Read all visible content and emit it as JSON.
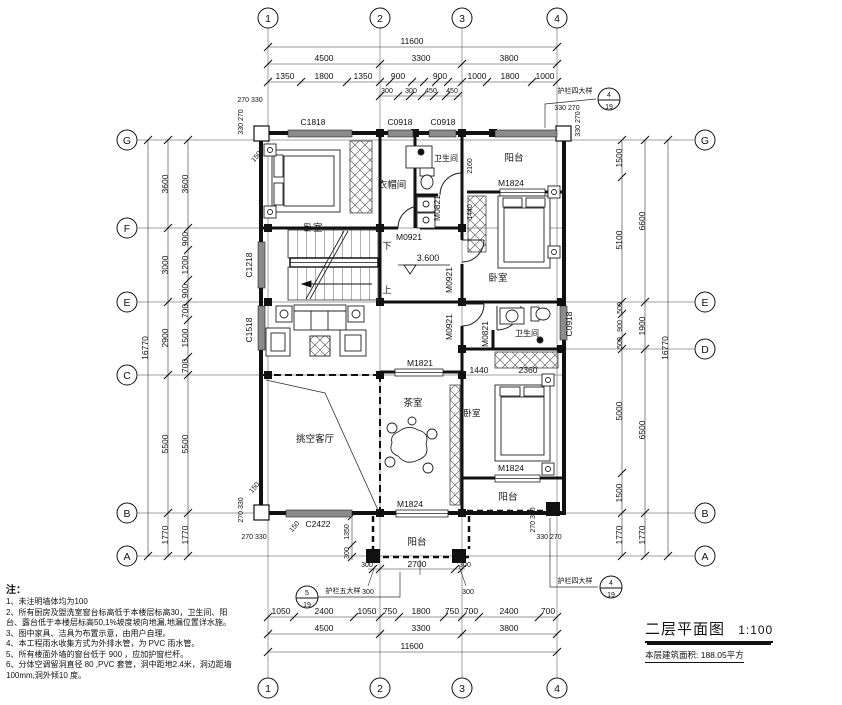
{
  "axes": {
    "top": [
      "1",
      "2",
      "3",
      "4"
    ],
    "bottom": [
      "1",
      "2",
      "3",
      "4"
    ],
    "left": [
      "G",
      "F",
      "E",
      "C",
      "B",
      "A"
    ],
    "right": [
      "G",
      "E",
      "D",
      "B",
      "A"
    ]
  },
  "dims_top": {
    "overall": "11600",
    "row2": [
      "4500",
      "3300",
      "3800"
    ],
    "row3": [
      "1350",
      "1800",
      "1350",
      "900",
      "900",
      "1000",
      "1800",
      "1000"
    ],
    "sub": [
      "300",
      "300",
      "450",
      "450"
    ]
  },
  "dims_bottom": {
    "overall": "11600",
    "row2": [
      "4500",
      "3300",
      "3800"
    ],
    "row3": [
      "1050",
      "2400",
      "1050",
      "750",
      "1800",
      "750",
      "700",
      "2400",
      "700"
    ]
  },
  "dims_left": {
    "overall": "16770",
    "mid": [
      "3600",
      "3000",
      "2900",
      "5500",
      "1770"
    ],
    "fine": [
      "3600",
      "900",
      "1200",
      "900",
      "700",
      "1500",
      "700",
      "5500",
      "1770"
    ]
  },
  "dims_right": {
    "overall": "16770",
    "mid": [
      "6600",
      "1900",
      "6500",
      "1770"
    ],
    "fine": [
      "1500",
      "5100",
      "500",
      "900",
      "500",
      "5000",
      "1500",
      "1770"
    ]
  },
  "corner_dims": {
    "tl_h": "270 330",
    "tl_v": "330 270",
    "tr_h": "330 270",
    "tr_v": "330 270",
    "bl_h": "270 330",
    "bl_v": "270 330",
    "br_h": "330 270",
    "br_v": "270 330",
    "offset150": "150"
  },
  "rooms": {
    "bedroom_tl": "卧室",
    "closet": "衣帽间",
    "bath_top": "卫生间",
    "balcony_tr": "阳台",
    "bedroom_r": "卧室",
    "bath_mid": "卫生间",
    "bedroom_br": "卧室",
    "balcony_br": "阳台",
    "tea_room": "茶室",
    "living_void": "挑空客厅",
    "balcony_b": "阳台"
  },
  "openings": {
    "c1818": "C1818",
    "c0918_a": "C0918",
    "c0918_b": "C0918",
    "c0918_r": "C0918",
    "c1218": "C1218",
    "c1518": "C1518",
    "c2422": "C2422",
    "m0821_a": "M0821",
    "m0821_b": "M0821",
    "m0921_a": "M0921",
    "m0921_b": "M0921",
    "m0921_c": "M0921",
    "m1821": "M1821",
    "m1824_a": "M1824",
    "m1824_b": "M1824",
    "m1824_c": "M1824"
  },
  "ann": {
    "level": "3.600",
    "up": "上",
    "down": "下",
    "rail4": "护栏四大样",
    "rail5": "护栏五大样",
    "c4_num": "4",
    "c4_sheet": "19",
    "c5_num": "5",
    "c5_sheet": "19",
    "d2160": "2160",
    "d1440": "1440",
    "d2360": "2360",
    "d2700": "2700",
    "d1350": "1350",
    "d300": "300"
  },
  "title_block": {
    "title": "二层平面图",
    "scale": "1:100",
    "area": "本层建筑面积: 188.05平方"
  },
  "notes": {
    "heading": "注：",
    "items": [
      "1、未注明墙体均为100",
      "2、所有厨房及盥洗室窗台标高低于本楼层标高30，卫生间、阳台、露台低于本楼层标高50,1%坡度坡向地漏,地漏位置详水施。",
      "3、图中家具、洁具为布置示意，由用户自理。",
      "4、本工程雨水收集方式为外排水管，为 PVC 雨水管。",
      "5、所有楼面外墙的窗台低于 900 ，应加护窗栏杆。",
      "6、分体空调留洞直径 80 ,PVC 套管，洞中距地2.4米，洞边距墙 100mm,洞外倾10 度。"
    ]
  }
}
